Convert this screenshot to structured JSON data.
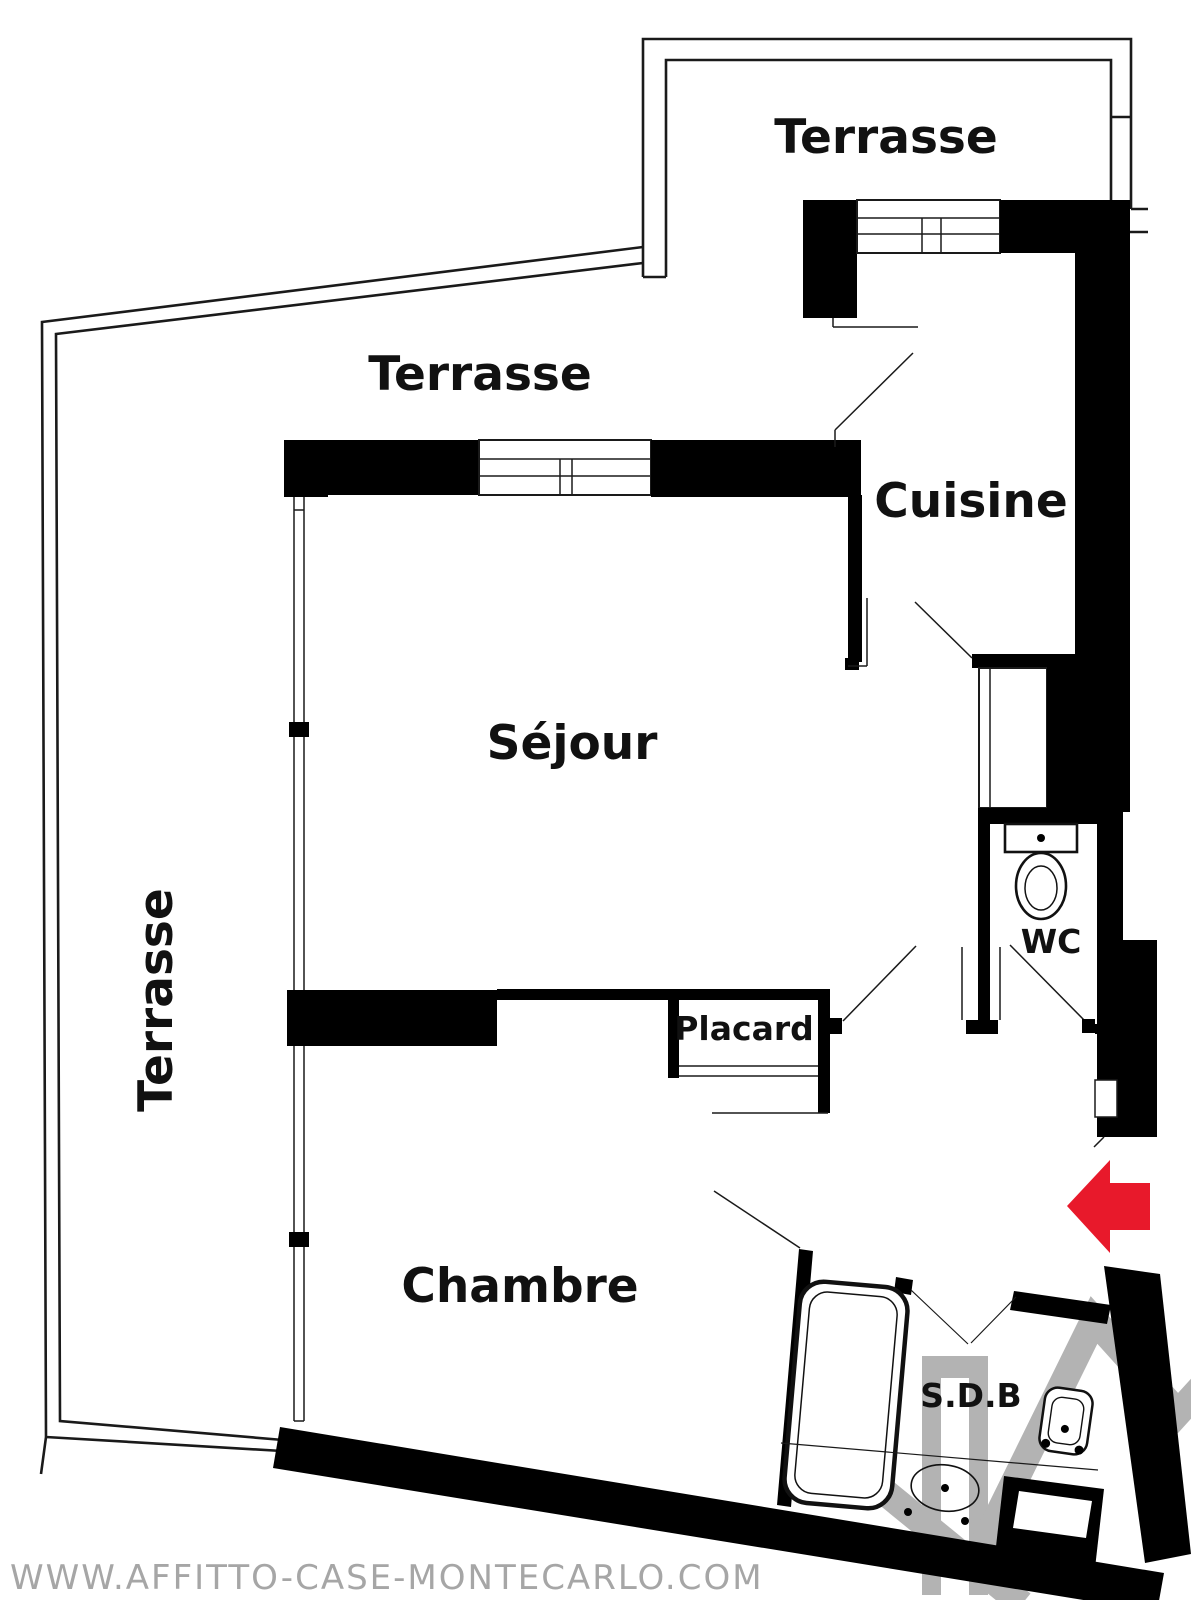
{
  "labels": {
    "terrasse_top": "Terrasse",
    "terrasse_middle": "Terrasse",
    "terrasse_left": "Terrasse",
    "cuisine": "Cuisine",
    "sejour": "Séjour",
    "chambre": "Chambre",
    "placard": "Placard",
    "wc": "WC",
    "sdb": "S.D.B"
  },
  "watermark": {
    "site_url": "WWW.AFFITTO-CASE-MONTECARLO.COM"
  },
  "colors": {
    "background": "#ffffff",
    "wall_black": "#000000",
    "line_dark": "#1a1a1a",
    "entrance_arrow_red": "#e8192b",
    "watermark_gray": "#b3b3b3",
    "watermark_text_gray": "#a6a6a6"
  }
}
